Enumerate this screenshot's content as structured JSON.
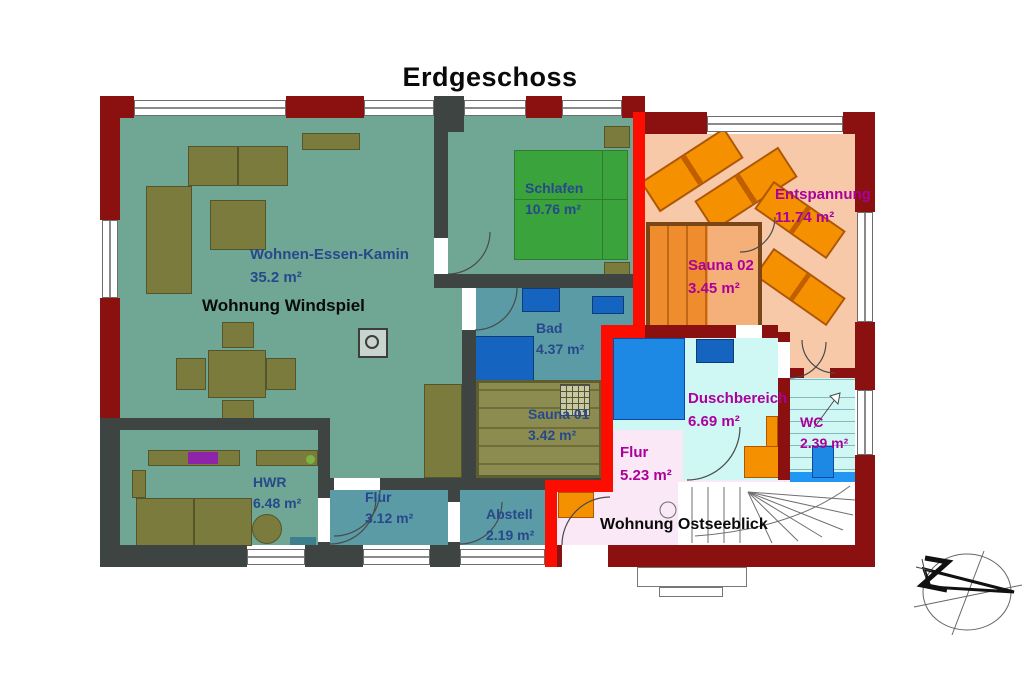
{
  "title": "Erdgeschoss",
  "apartments": {
    "windspiel": {
      "label": "Wohnung Windspiel"
    },
    "ostseeblick": {
      "label": "Wohnung Ostseeblick"
    }
  },
  "rooms": {
    "wohnen": {
      "name": "Wohnen-Essen-Kamin",
      "area": "35.2 m²"
    },
    "schlafen": {
      "name": "Schlafen",
      "area": "10.76 m²"
    },
    "entspannung": {
      "name": "Entspannung",
      "area": "11.74 m²"
    },
    "sauna02": {
      "name": "Sauna 02",
      "area": "3.45 m²"
    },
    "bad": {
      "name": "Bad",
      "area": "4.37 m²"
    },
    "sauna01": {
      "name": "Sauna 01",
      "area": "3.42 m²"
    },
    "duschbereich": {
      "name": "Duschbereich",
      "area": "6.69 m²"
    },
    "wc": {
      "name": "WC",
      "area": "2.39 m²"
    },
    "flur_og": {
      "name": "Flur",
      "area": "5.23 m²"
    },
    "hwr": {
      "name": "HWR",
      "area": "6.48 m²"
    },
    "flur_ws": {
      "name": "Flur",
      "area": "3.12 m²"
    },
    "abstell": {
      "name": "Abstell",
      "area": "2.19 m²"
    }
  },
  "colors": {
    "wall_brick": "#8B1110",
    "wall_highlight": "#FB0D00",
    "wall_interior": "#3E4441",
    "floor_living": "#6FA794",
    "floor_bath": "#5A9BA6",
    "floor_relax": "#F7C9A9",
    "floor_shower": "#CFF7F4",
    "floor_hall_pink": "#FAE8F6",
    "furniture_olive": "#7B7B3D",
    "furniture_orange": "#F59000",
    "fixture_blue": "#1E88E5",
    "bed_green": "#3BA33B",
    "text_blue": "#27498C",
    "text_magenta": "#AB009B"
  }
}
